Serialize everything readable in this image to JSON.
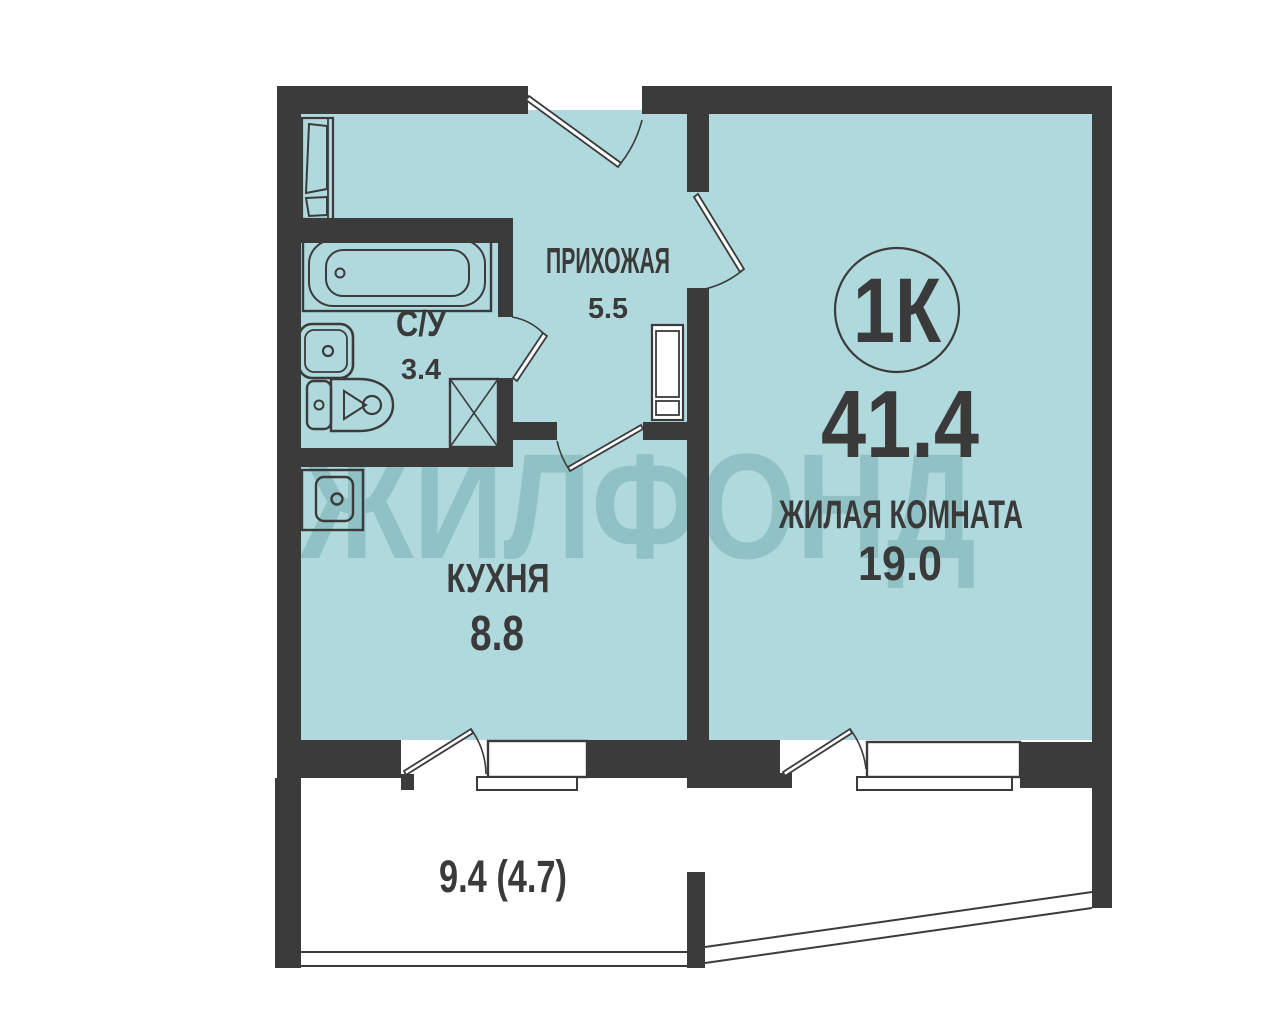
{
  "plan": {
    "watermark": "ЖИЛФОНД",
    "apartment_type_badge": "1К",
    "total_area": "41.4",
    "rooms": {
      "hallway": {
        "name": "ПРИХОЖАЯ",
        "area": "5.5"
      },
      "bathroom": {
        "name": "С/У",
        "area": "3.4"
      },
      "kitchen": {
        "name": "КУХНЯ",
        "area": "8.8"
      },
      "living_room": {
        "name": "ЖИЛАЯ КОМНАТА",
        "area": "19.0"
      }
    },
    "balcony": {
      "area": "9.4 (4.7)"
    },
    "colors": {
      "wall": "#3b3b3b",
      "floor_fill": "#b0d9dd",
      "watermark": "#8dbfc4",
      "line": "#3b3b3b"
    }
  }
}
